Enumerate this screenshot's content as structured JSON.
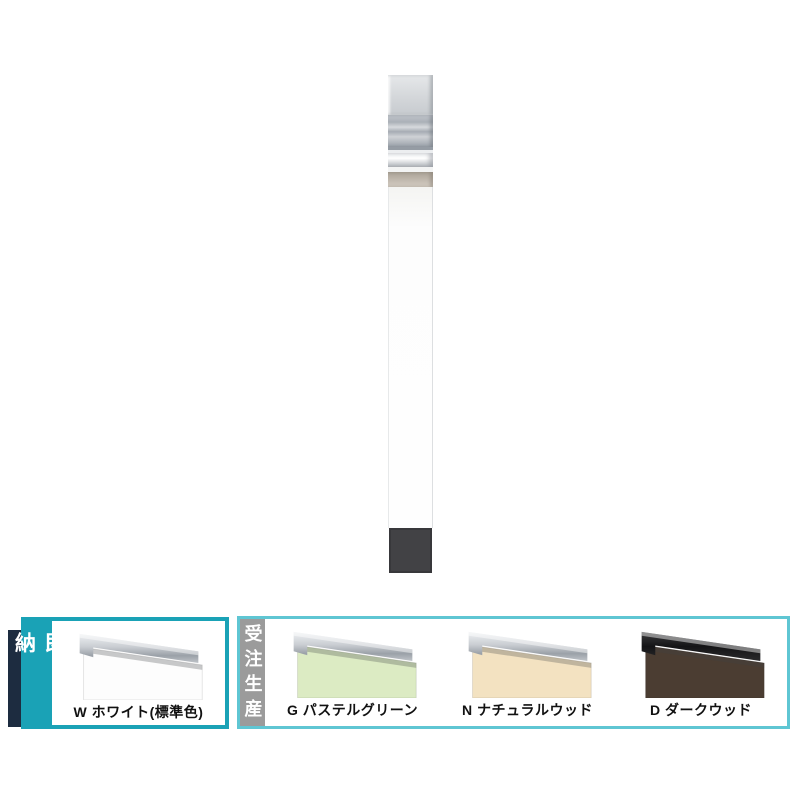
{
  "page": {
    "background": "#ffffff"
  },
  "product": {
    "pole": {
      "cap_color": "#d5d8db",
      "bracket_color": "#b0b6bd",
      "silver_band_color": "#e9ebed",
      "tan_band_color": "#b9b0a4",
      "body_color": "#fdfdfd",
      "base_color": "#424245"
    }
  },
  "availability": {
    "accent_bar_color": "#1d2c40",
    "sections": [
      {
        "tag": "即納",
        "tag_color": "#1aa2b6",
        "border_color": "#1aa2b6",
        "swatches": [
          {
            "code": "W",
            "label": "W ホワイト(標準色)",
            "panel_color": "#fdfdfd",
            "rail_fill": "url(#rail-silver)"
          }
        ]
      },
      {
        "tag": "受注生産",
        "tag_color": "#9b9b9b",
        "border_color": "#5fc6d3",
        "swatches": [
          {
            "code": "G",
            "label": "G パステルグリーン",
            "panel_color": "#dcebc3",
            "rail_fill": "url(#rail-silver)"
          },
          {
            "code": "N",
            "label": "N ナチュラルウッド",
            "panel_color": "#f3e2c1",
            "rail_fill": "url(#rail-silver)"
          },
          {
            "code": "D",
            "label": "D ダークウッド",
            "panel_color": "#4b3d32",
            "rail_fill": "url(#rail-dark)"
          }
        ]
      }
    ]
  }
}
